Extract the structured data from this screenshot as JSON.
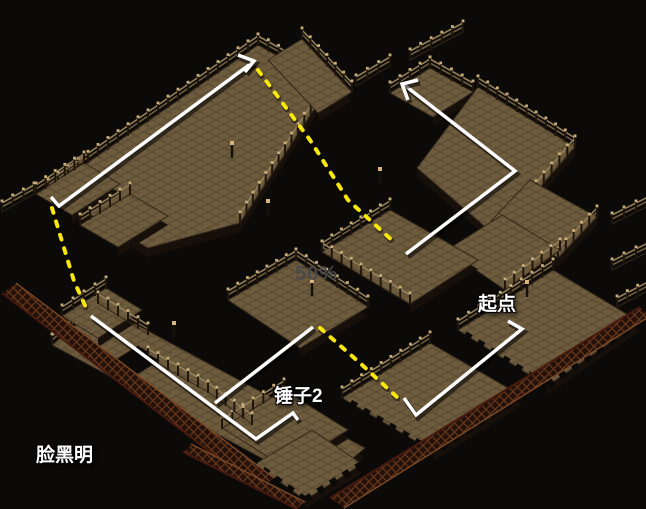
{
  "window": {
    "width": 646,
    "height": 509
  },
  "labels": {
    "start_point": "起点",
    "hammer2": "锤子2",
    "signature": "脸黑明",
    "watermark": "50%"
  },
  "colors": {
    "background": "#0c0a08",
    "floor": "#6d5b3e",
    "route_line": "#ffffff",
    "guide_dashed": "#f7e70d",
    "label_text": "#ffffff",
    "watermark_text": "#4a4a4a"
  },
  "routes": [
    {
      "name": "upper-hall-route",
      "points": [
        [
          51,
          197
        ],
        [
          59,
          206
        ],
        [
          253,
          62
        ]
      ]
    },
    {
      "name": "upper-hall-arrowhead",
      "points": [
        [
          238,
          55
        ],
        [
          254,
          61
        ],
        [
          245,
          72
        ]
      ]
    },
    {
      "name": "lower-hall-route",
      "points": [
        [
          91,
          316
        ],
        [
          256,
          439
        ],
        [
          293,
          413
        ],
        [
          298,
          420
        ]
      ]
    },
    {
      "name": "center-link-route",
      "points": [
        [
          313,
          327
        ],
        [
          215,
          403
        ]
      ]
    },
    {
      "name": "midwalk-to-north-route",
      "points": [
        [
          406,
          254
        ],
        [
          515,
          171
        ],
        [
          403,
          84
        ]
      ]
    },
    {
      "name": "north-arrowhead",
      "points": [
        [
          418,
          80
        ],
        [
          402,
          84
        ],
        [
          408,
          100
        ]
      ]
    },
    {
      "name": "start-route",
      "points": [
        [
          508,
          321
        ],
        [
          522,
          329
        ],
        [
          416,
          415
        ],
        [
          404,
          398
        ]
      ]
    }
  ],
  "guides": [
    {
      "name": "guide-west",
      "points": [
        [
          52,
          208
        ],
        [
          64,
          248
        ],
        [
          74,
          281
        ],
        [
          88,
          312
        ]
      ]
    },
    {
      "name": "guide-center",
      "points": [
        [
          258,
          70
        ],
        [
          310,
          140
        ],
        [
          348,
          200
        ],
        [
          395,
          243
        ]
      ]
    },
    {
      "name": "guide-southeast",
      "points": [
        [
          320,
          328
        ],
        [
          360,
          363
        ],
        [
          398,
          398
        ]
      ]
    }
  ]
}
